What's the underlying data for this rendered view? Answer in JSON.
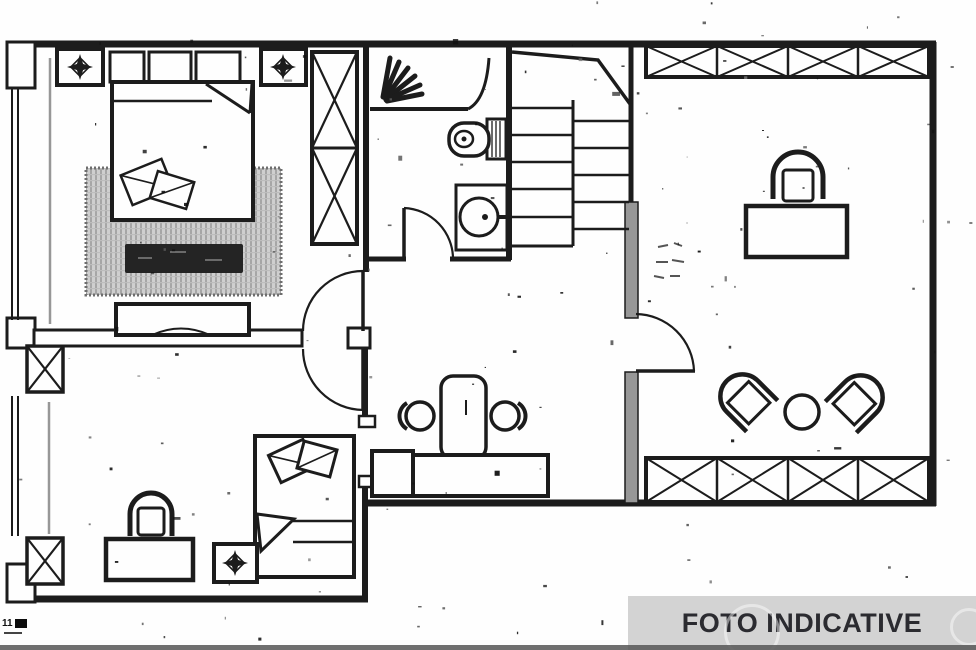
{
  "banner": {
    "label": "FOTO INDICATIVE",
    "bg": "#d3d3d3",
    "fg": "#2b2b30"
  },
  "artifact": {
    "label": "11"
  },
  "palette": {
    "paper": "#fefefe",
    "ink": "#1c1c1c",
    "wall_gray": "#979797",
    "rug_base": "#cfcfcf",
    "rug_stripe": "#a6a6a6",
    "bench": "#242424",
    "footer_bar": "#565656"
  },
  "symbols": [
    {
      "name": "ceiling-light-icon"
    },
    {
      "name": "shower-spray-icon"
    },
    {
      "name": "toilet-icon"
    },
    {
      "name": "sink-icon"
    },
    {
      "name": "stairs-icon"
    },
    {
      "name": "wardrobe-x-icon"
    },
    {
      "name": "double-bed-icon"
    },
    {
      "name": "single-bed-icon"
    },
    {
      "name": "rug-icon"
    },
    {
      "name": "bench-icon"
    },
    {
      "name": "dresser-icon"
    },
    {
      "name": "desk-icon"
    },
    {
      "name": "office-chair-icon"
    },
    {
      "name": "armchair-icon"
    },
    {
      "name": "round-table-icon"
    },
    {
      "name": "bar-table-icon"
    },
    {
      "name": "stool-icon"
    },
    {
      "name": "door-swing-icon"
    },
    {
      "name": "window-icon"
    },
    {
      "name": "column-x-icon"
    }
  ]
}
